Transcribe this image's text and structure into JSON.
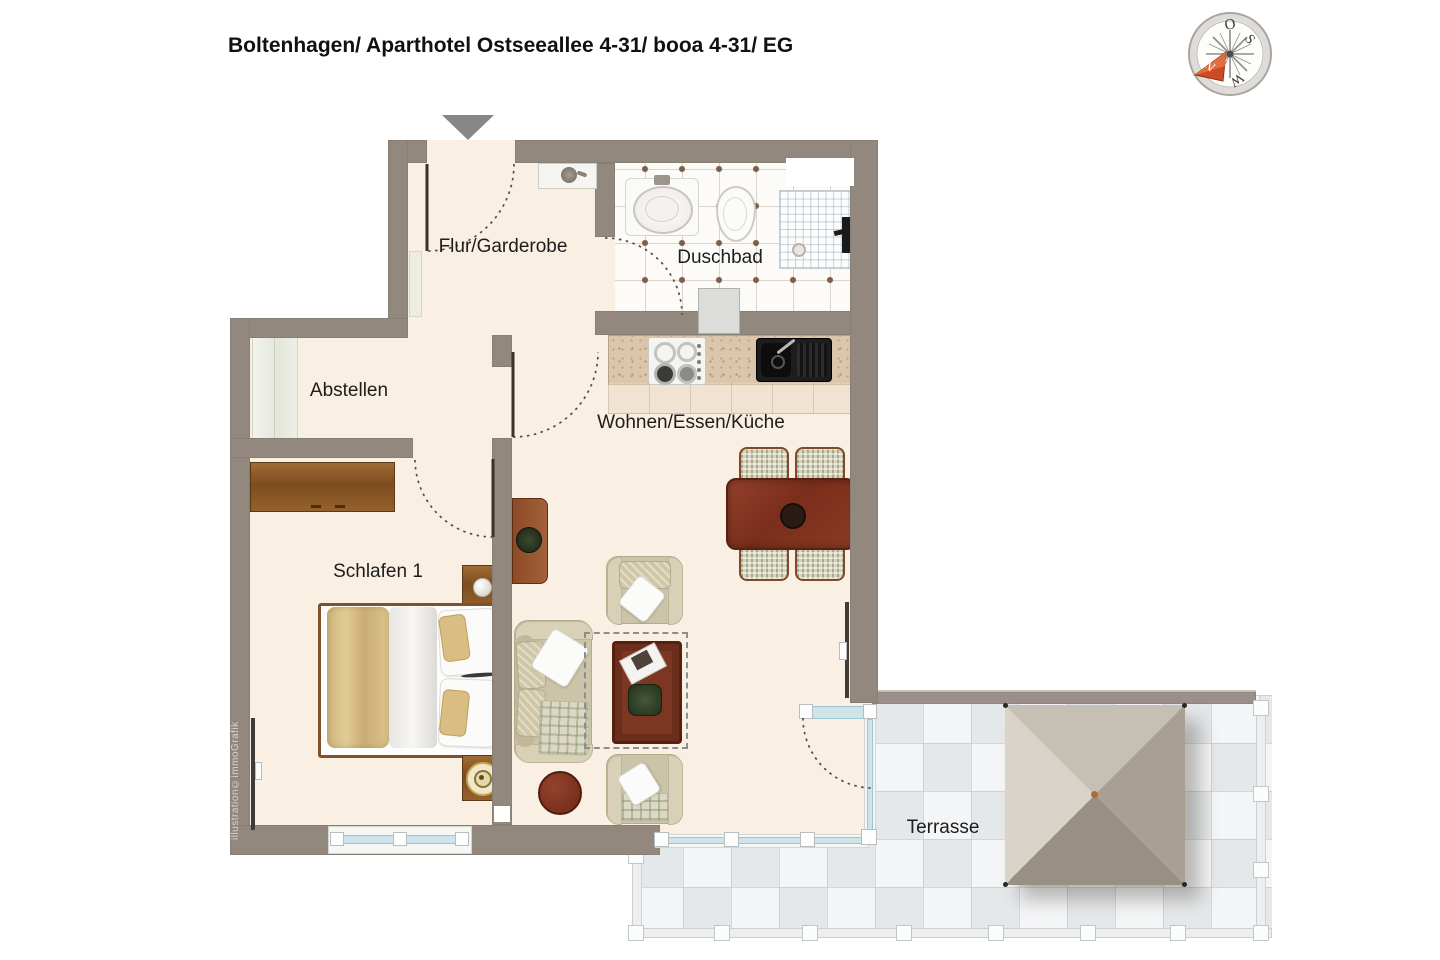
{
  "title": "Boltenhagen/ Aparthotel Ostseeallee 4-31/ booa 4-31/ EG",
  "rooms": {
    "flur": {
      "label": "Flur/Garderobe"
    },
    "duschbad": {
      "label": "Duschbad"
    },
    "abstellen": {
      "label": "Abstellen"
    },
    "wohnen": {
      "label": "Wohnen/Essen/Küche"
    },
    "schlafen": {
      "label": "Schlafen 1"
    },
    "terrasse": {
      "label": "Terrasse"
    }
  },
  "compass": {
    "north": "N",
    "east": "O",
    "south": "S",
    "west": "W"
  },
  "watermark": "illustration©immoGrafik",
  "colors": {
    "wall": "#92887d",
    "floor": "#f9efe3",
    "bath_tile_dot": "#7d5e4b",
    "terrace_tile": "#e5e8ea",
    "window_glass": "#cfe4ea",
    "wood_dark": "#7a2e1b",
    "wood_light": "#94612c",
    "entrance_arrow": "#878787",
    "compass_needle": "#cc4a26"
  }
}
